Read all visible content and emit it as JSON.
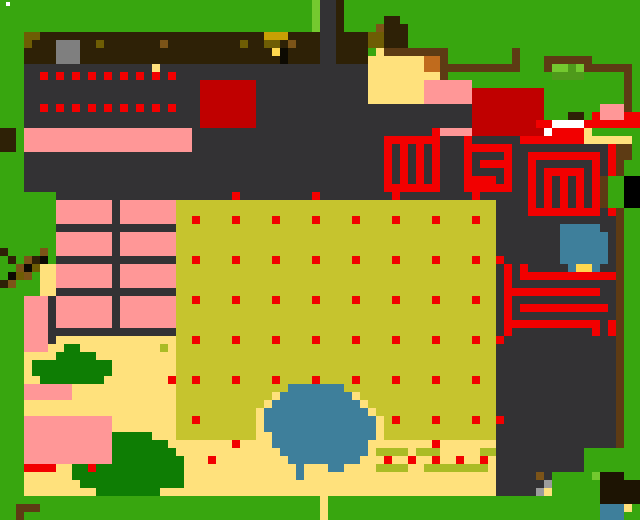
{
  "meta": {
    "description": "pixel-art overhead farm/village game map",
    "width": 640,
    "height": 520,
    "cell_size": 8,
    "grid_cols": 80,
    "grid_rows": 65
  },
  "palette": {
    "G": "#38a60f",
    "g": "#74c92f",
    "m": "#4f9a1b",
    "D": "#0e7d04",
    ".": "#333234",
    "S": "#7f7f7f",
    "B": "#2e2106",
    "b": "#5d3b14",
    "n": "#7c5418",
    "c": "#c06b1d",
    "o": "#6e5d04",
    "q": "#c8a004",
    "Y": "#ffd84f",
    "x": "#0d0a02",
    "K": "#c6c42e",
    "L": "#aabc25",
    "t": "#ffe17c",
    "P": "#ff9797",
    "R": "#f20000",
    "E": "#c00000",
    "W": "#ffffff",
    "U": "#3e7f9b",
    "N": "#1d1403",
    "C": "#9c9c9c"
  },
  "palette_legend": {
    "G": "grass-green",
    "g": "light-green",
    "m": "medium-green",
    "D": "dark-green-bush",
    ".": "dark-gray-floor",
    "S": "stone-gray",
    "B": "dark-soil-brown",
    "b": "fence-brown",
    "n": "mid-brown",
    "c": "orange-crate",
    "o": "dark-olive",
    "q": "olive-gold",
    "Y": "bright-yellow",
    "x": "black",
    "K": "khaki-field",
    "L": "light-olive-sprout",
    "t": "sand-tan",
    "P": "pink",
    "R": "bright-red",
    "E": "dark-red",
    "W": "white",
    "U": "pond-blue",
    "N": "near-black-brown",
    "C": "light-gray"
  },
  "grid_rle_rows": [
    "39G 1g 2. 1B 37G",
    "39G 1g 2. 1B 37G",
    "39G 1g 2. 1B 5G 2B 30G",
    "39G 1g 2. 1B 4G 1n 3B 29G",
    "3G 2o 28B 3q 4B 2. 4B 2o 3B 29G",
    "3G 1o 3B 3S 2B 1o 7B 1n 9B 1o 2B 2o 1B 1n 3B 2. 4B 2o 3B 29G",
    "3G 4B 3S 24B 1Y 1x 4B 2. 4B 1G 1t 8b 8G 1b 15G",
    "3G 4B 3S 25B 1x 4B 2. 4B 7t 2c 1b 8G 1b 3G 6b 6G",
    "3G 16. 1t 26. 7t 2c 10b 3G 1b 2g 1m 1g 6b 1G",
    "3G 2. 1R 1. 1R 1. 1R 1. 1R 1. 1R 1. 1R 1. 1R 1. 1R 1. 1R 24. 9t 1b 13G 4m 5G 1b 1G",
    "3G 22. 7E 14. 7t 6P 19G 1b 1G",
    "3G 22. 7E 14. 7t 6P 9E 10G 1b 1G",
    "3G 22. 7E 14. 7t 6P 9E 10G 1b 1G",
    "3G 2. 1R 1. 1R 1. 1R 1. 1R 1. 1R 1. 1R 1. 1R 1. 1R 1. 1R 3. 7E 27. 9E 7G 3P 1b 1G",
    "3G 22. 7E 27. 9E 3G 2B 1G 1R 3P 2R",
    "3G 22. 7E 27. 8E 2R 4W 7R",
    "2B 1G 21P 30. 1R 4P 9E 1W 4R 1t 6G",
    "2B 1G 21P 24. 7R 3. 1R 6. 8R 6t 1G",
    "2B 1G 21P 24. 1R 1. 1R 1. 1R 1. 1R 3. 6R 12. 1R 2b 1G",
    "3G 45. 1R 1. 1R 1. 1R 1. 1R 3. 1R 4. 1R 2. 9R 1. 1R 2b 1G",
    "3G 45. 1R 1. 1R 1. 1R 1. 1R 3. 1R 1. 4R 2. 1R 7. 1R 1. 1R 1b 2G",
    "3G 45. 1R 1. 1R 1. 1R 1. 1R 3. 1R 4. 1R 2. 1R 1. 5R 1. 1R 1. 1R 1b 2G",
    "3G 45. 1R 1. 1R 1. 1R 1. 1R 3. 4R 1. 1R 2. 1R 1. 1R 1. 1R 1. 1R 1. 1R 1b 2G",
    "3G 45. 7R 3. 6R 2. 1R 1. 1R 1. 1R 1. 1R 1. 1R 1b 2G",
    "7G 22. 1R 9. 1R 9. 1R 9. 1R 6. 1R 1. 1R 1. 1R 1. 1R 1. 1R 1b 2G",
    "7G 7P 1. 7P 40K 4. 1R 1. 1R 1. 1R 1. 1R 1. 1R 1b 2G",
    "7G 7P 1. 7P 40K 4. 9R 1. 1R 1b 2G",
    "7G 7P 1. 7P 2K 1R 4K 1R 4K 1R 4K 1R 4K 1R 4K 1R 4K 1R 4K 1R 2K 15. 1b 2G",
    "7G 15. 40K 8. 5U 2. 1b 2G",
    "7G 7P 1. 7P 40K 8. 6U 1. 1b 2G",
    "7G 7P 1. 7P 40K 8. 6U 1. 1b 2G",
    "1B 4G 1n 1G 7P 1. 7P 40K 8. 6U 1. 1b 2G",
    "1G 1B 1G 1n 1B 1x 1G 15. 2K 1R 4K 1R 4K 1R 4K 1R 4K 1R 4K 1R 4K 1R 4K 1R 2K 1R 7. 6U 1. 1b 2G",
    "2G 1n 1x 1o 2t 7P 1. 7P 40K 1. 1R 1. 1R 5. 1U 2Y 1U 2. 1b 2G",
    "1G 1x 1o 1n 1G 2t 7P 1. 7P 40K 1. 1R 1. 12R 1b 2G",
    "1B 1n 3G 2t 7P 1. 7P 40K 1. 1R 13. 1b 2G",
    "5G 2t 15. 40K 1. 12R 2. 1b 2G",
    "3G 3P 1. 7P 1. 7P 2K 1R 4K 1R 4K 1R 4K 1R 4K 1R 4K 1R 4K 1R 4K 1R 2K 1. 1R 13. 1b 2G",
    "3G 3P 1. 7P 1. 7P 40K 1. 1R 1. 11R 1. 1b 2G",
    "3G 3P 1. 7P 1. 7P 40K 1. 1R 13. 1b 2G",
    "3G 3P 1. 7P 1. 7P 40K 1. 12R 1. 1R 1b 2G",
    "3G 3P 16. 40K 1. 1R 10. 1R 1. 1R 1b 2G",
    "3G 3P 1. 15t 2K 1R 4K 1R 4K 1R 4K 1R 4K 1R 4K 1R 4K 1R 4K 1R 2K 1R 14. 1b 2G",
    "3G 3P 2t 2D 10t 1L 1t 40K 15. 1b 2G",
    "3G 4t 5D 10t 40K 15. 1b 2G",
    "3G 1t 10D 8t 40K 15. 1b 2G",
    "3G 1t 10D 8t 40K 15. 1b 2G",
    "3G 2t 8D 8t 1R 2K 1R 4K 1R 4K 1R 4K 1R 4K 1R 4K 1R 4K 1R 4K 1R 2K 15. 1b 2G",
    "3G 6P 13t 14K 7U 19K 15. 1b 2G",
    "3G 6P 13t 12K 1t 9U 1t 17K 15. 1b 2G",
    "3G 19t 11K 1t 11U 1t 16K 15. 1b 2G",
    "3G 19t 10K 1t 13U 1t 15K 15. 1b 2G",
    "3G 11P 8t 2K 1R 7K 1t 14U 1t 1K 1R 4K 1R 4K 1R 2K 1R 14. 1b 2G",
    "3G 11P 8t 10K 1t 14U 1t 14K 15. 1b 2G",
    "3G 11P 5D 3t 10K 2t 13U 1t 14K 15. 1b 2G",
    "3G 11P 7D 1t 7t 1R 4t 12U 8t 1R 7t 15. 1b 2G",
    "3G 11P 8D 13t 11U 1t 4L 1t 3L 5t 2L 11. 7G",
    "3G 11P 8D 1D 3t 1R 9t 9U 3t 1R 2t 1R 2t 1R 2t 1R 2t 1R 1t 11. 7G",
    "3G 4R 2t 2D 1R 10D 1D 14t 1U 3t 2U 4t 4L 2t 8L 1t 11. 7G",
    "3G 6t 13D 1D 14t 1U 24t 5. 1n 1. 5G 1g 3N 2G",
    "3G 7t 12D 1D 39t 6. 1C 6G 5N",
    "3G 9t 8D 2t 40t 5. 1C 1t 6G 5N",
    "40G 1t 34G 5N",
    "2G 3b 35G 1t 34G 3U 1t 1G",
    "2G 1b 37G 1t 34G 3U 2G"
  ],
  "sparkle": {
    "x": 6,
    "y": 2,
    "w": 4,
    "h": 4,
    "color": "#ffffff"
  },
  "regions": [
    {
      "name": "tilled-soil-strip",
      "x": 24,
      "y": 32,
      "w": 296,
      "h": 32,
      "interactable": true
    },
    {
      "name": "stone-block",
      "x": 56,
      "y": 40,
      "w": 24,
      "h": 24,
      "interactable": true
    },
    {
      "name": "seed-tray-grid",
      "x": 32,
      "y": 64,
      "w": 152,
      "h": 56,
      "interactable": true
    },
    {
      "name": "red-mat",
      "x": 200,
      "y": 80,
      "w": 56,
      "h": 48,
      "interactable": true
    },
    {
      "name": "pink-counter",
      "x": 24,
      "y": 128,
      "w": 168,
      "h": 32,
      "interactable": true
    },
    {
      "name": "path-top",
      "x": 320,
      "y": 0,
      "w": 16,
      "h": 64,
      "interactable": true
    },
    {
      "name": "courtyard-tan",
      "x": 368,
      "y": 56,
      "w": 64,
      "h": 48,
      "interactable": false
    },
    {
      "name": "orange-crate",
      "x": 424,
      "y": 56,
      "w": 16,
      "h": 16,
      "interactable": true
    },
    {
      "name": "pink-awning",
      "x": 424,
      "y": 80,
      "w": 48,
      "h": 24,
      "interactable": true
    },
    {
      "name": "farmhouse-red",
      "x": 472,
      "y": 88,
      "w": 72,
      "h": 48,
      "interactable": true
    },
    {
      "name": "fenced-hedge",
      "x": 544,
      "y": 56,
      "w": 48,
      "h": 24,
      "interactable": true
    },
    {
      "name": "pink-stall-topright",
      "x": 600,
      "y": 104,
      "w": 24,
      "h": 16,
      "interactable": true
    },
    {
      "name": "red-maze-gate-left",
      "x": 384,
      "y": 136,
      "w": 64,
      "h": 64,
      "interactable": true
    },
    {
      "name": "red-maze-gate-mid",
      "x": 464,
      "y": 136,
      "w": 56,
      "h": 64,
      "interactable": true
    },
    {
      "name": "red-maze-spiral",
      "x": 528,
      "y": 152,
      "w": 80,
      "h": 64,
      "interactable": true
    },
    {
      "name": "red-maze-comb",
      "x": 496,
      "y": 256,
      "w": 128,
      "h": 88,
      "interactable": true
    },
    {
      "name": "blue-hut",
      "x": 560,
      "y": 224,
      "w": 48,
      "h": 48,
      "interactable": true
    },
    {
      "name": "crop-field",
      "x": 176,
      "y": 200,
      "w": 320,
      "h": 240,
      "interactable": true
    },
    {
      "name": "bunk-tables-room",
      "x": 56,
      "y": 200,
      "w": 120,
      "h": 128,
      "interactable": true
    },
    {
      "name": "tree-canopy-left",
      "x": 0,
      "y": 184,
      "w": 56,
      "h": 104,
      "interactable": false
    },
    {
      "name": "pink-closet",
      "x": 24,
      "y": 296,
      "w": 24,
      "h": 56,
      "interactable": true
    },
    {
      "name": "bush-small-left",
      "x": 24,
      "y": 344,
      "w": 88,
      "h": 40,
      "interactable": false
    },
    {
      "name": "pink-rug-small",
      "x": 24,
      "y": 384,
      "w": 48,
      "h": 16,
      "interactable": true
    },
    {
      "name": "pink-house-small",
      "x": 24,
      "y": 416,
      "w": 88,
      "h": 48,
      "interactable": true
    },
    {
      "name": "red-doormat",
      "x": 24,
      "y": 464,
      "w": 32,
      "h": 8,
      "interactable": true
    },
    {
      "name": "bush-large-bottom",
      "x": 72,
      "y": 432,
      "w": 112,
      "h": 64,
      "interactable": false
    },
    {
      "name": "pond",
      "x": 264,
      "y": 384,
      "w": 112,
      "h": 96,
      "interactable": true
    },
    {
      "name": "sprout-row-dashes",
      "x": 376,
      "y": 440,
      "w": 112,
      "h": 32,
      "interactable": false
    },
    {
      "name": "character-sprite",
      "x": 536,
      "y": 472,
      "w": 16,
      "h": 24,
      "interactable": true
    },
    {
      "name": "dark-tree-bottomright",
      "x": 600,
      "y": 472,
      "w": 40,
      "h": 32,
      "interactable": false
    },
    {
      "name": "blue-dock",
      "x": 600,
      "y": 504,
      "w": 24,
      "h": 16,
      "interactable": true
    },
    {
      "name": "log-bench",
      "x": 16,
      "y": 504,
      "w": 24,
      "h": 16,
      "interactable": true
    },
    {
      "name": "fence-right-strip",
      "x": 616,
      "y": 144,
      "w": 8,
      "h": 304,
      "interactable": false
    },
    {
      "name": "path-bottom-gap",
      "x": 320,
      "y": 496,
      "w": 8,
      "h": 24,
      "interactable": true
    }
  ]
}
